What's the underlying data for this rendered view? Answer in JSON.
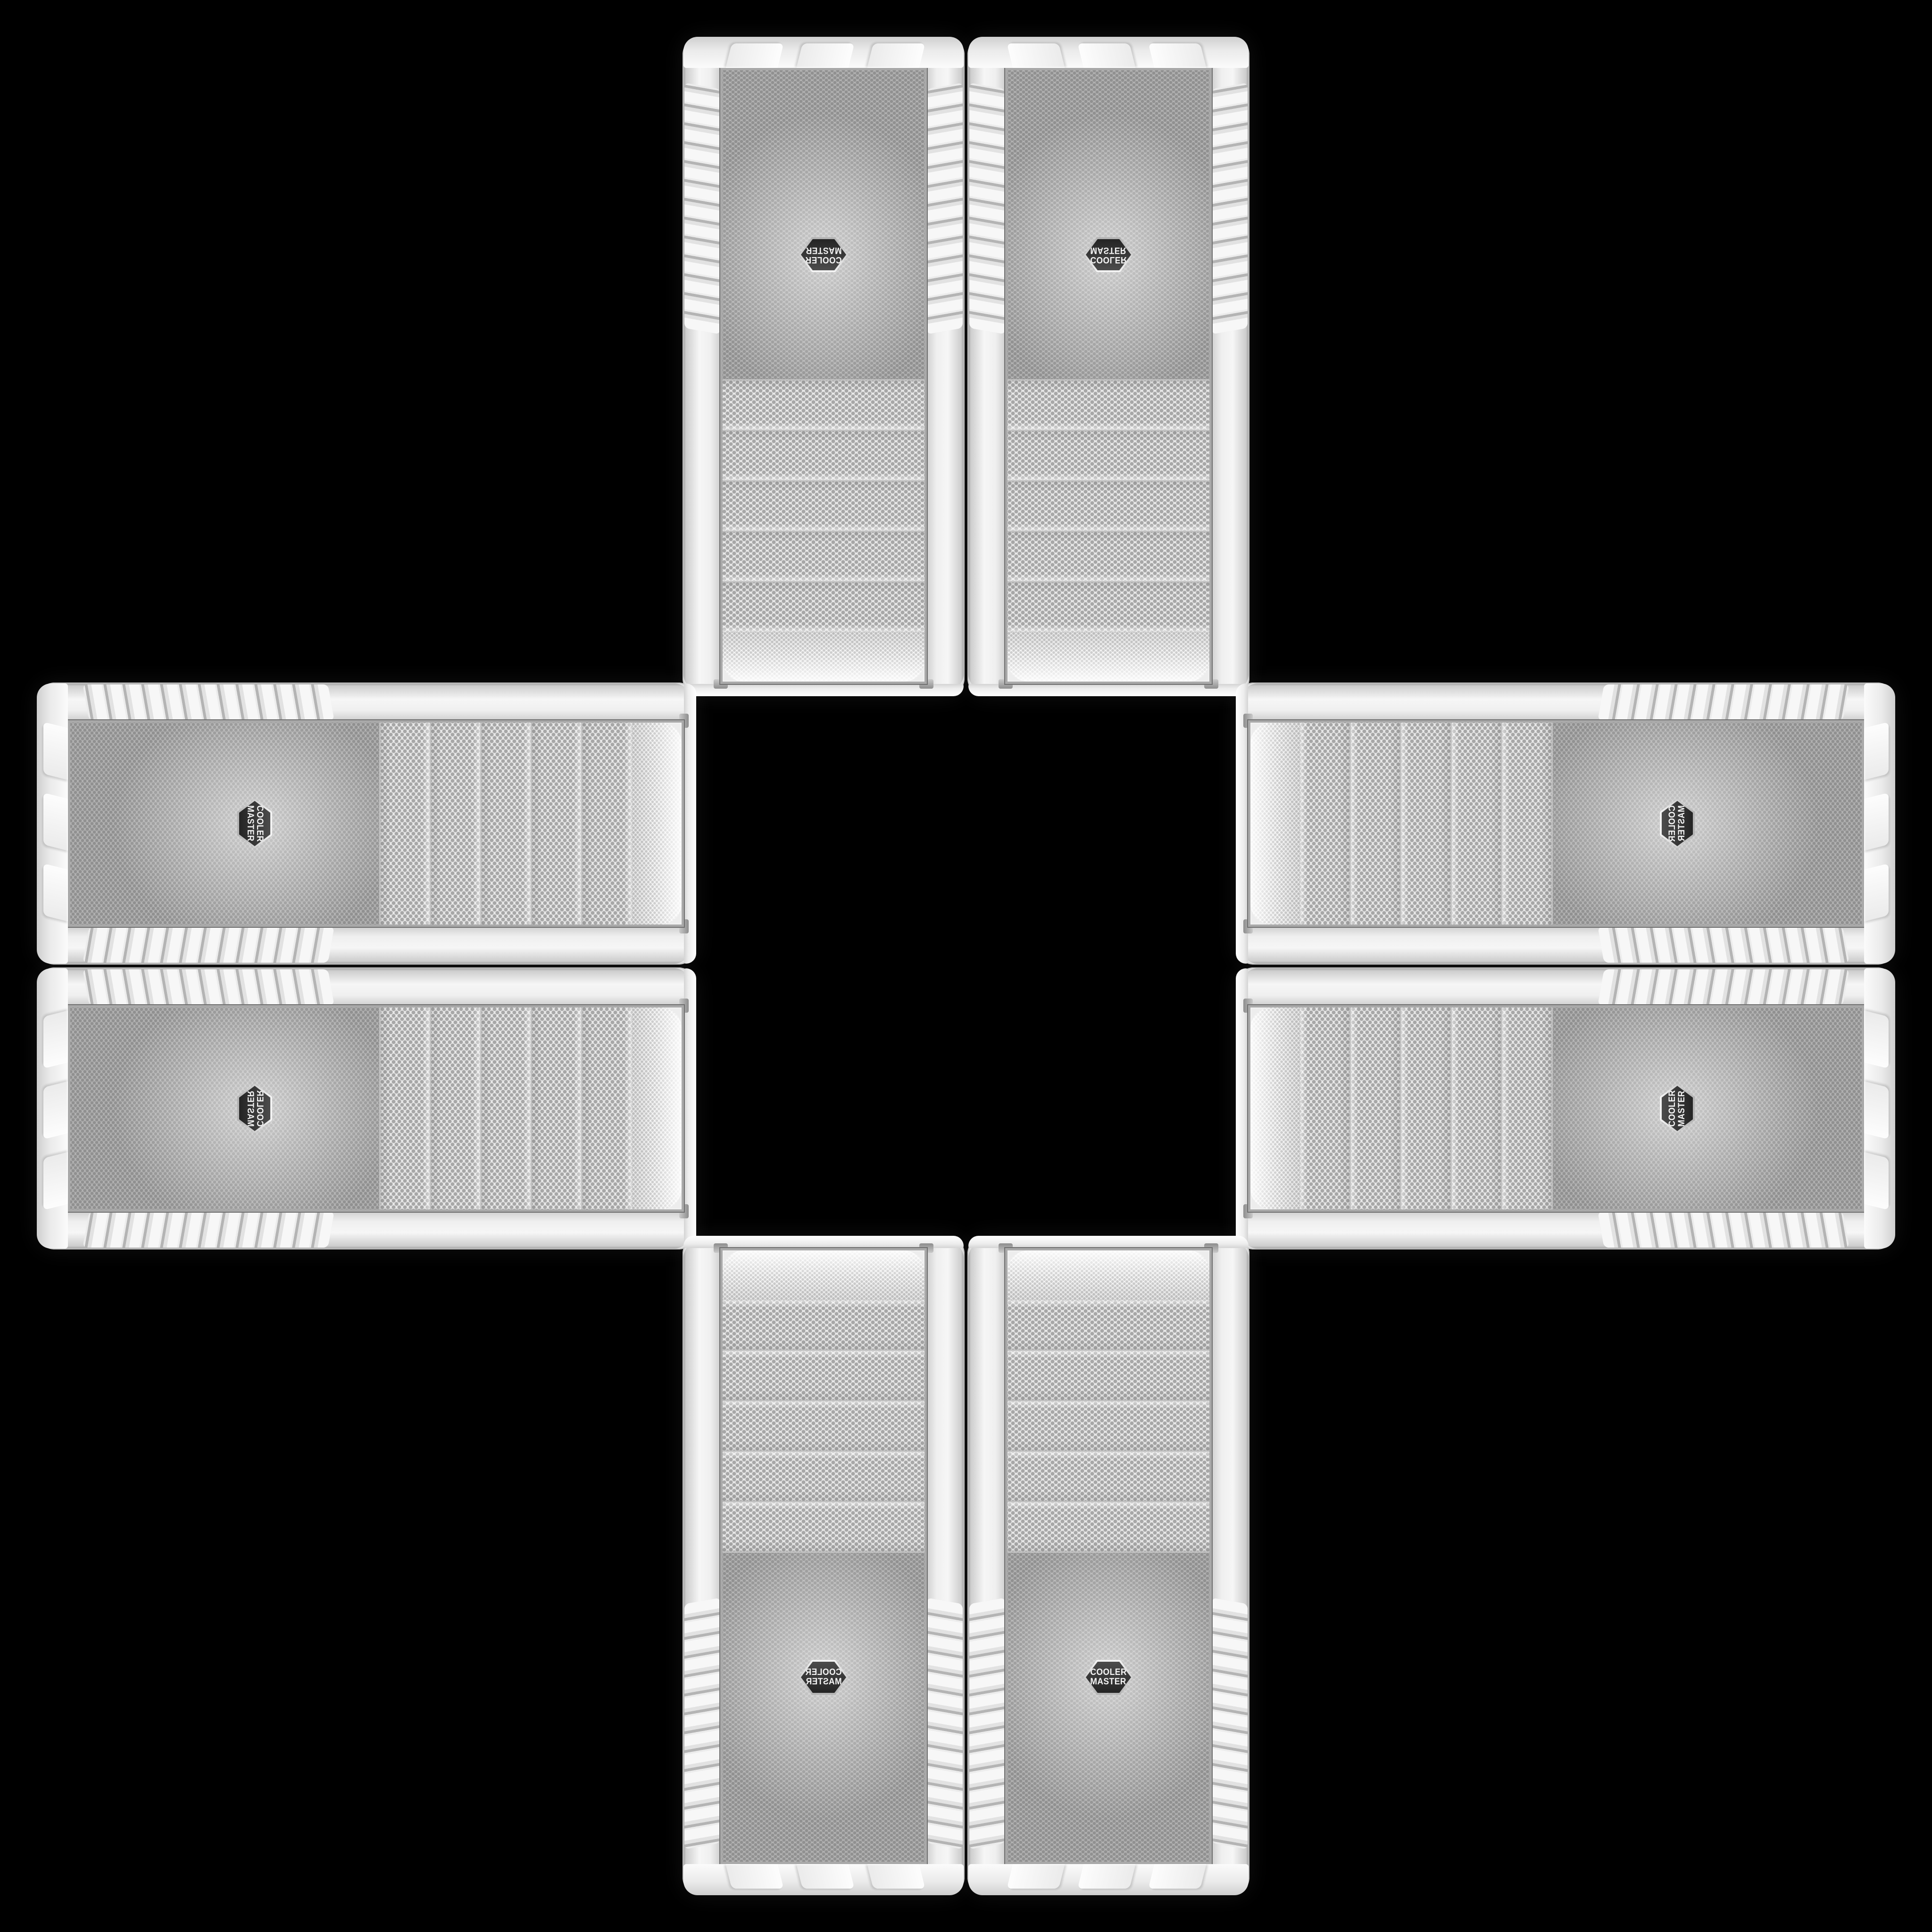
{
  "scene": {
    "description": "Eight identical white Cooler Master computer case front panels arranged edge-to-edge in a plus / cross kaleidoscope pattern on a black background",
    "background_color": "#000000",
    "panel_count": 8,
    "drive_bay_covers_per_panel": 5
  },
  "brand": {
    "line1": "COOLER",
    "line2": "MASTER"
  },
  "panels": [
    {
      "slot": "top-left",
      "orientation": "rotated 180"
    },
    {
      "slot": "top-right",
      "orientation": "rotated 180, mirrored"
    },
    {
      "slot": "left-top",
      "orientation": "rotated 90 clockwise"
    },
    {
      "slot": "right-top",
      "orientation": "rotated 90, mirrored"
    },
    {
      "slot": "left-bottom",
      "orientation": "rotated 90, flipped"
    },
    {
      "slot": "right-bottom",
      "orientation": "rotated 270"
    },
    {
      "slot": "bottom-left",
      "orientation": "mirrored"
    },
    {
      "slot": "bottom-right",
      "orientation": "upright"
    }
  ],
  "colors": {
    "shell": "#ececec",
    "shell_highlight": "#fafafa",
    "shell_shadow": "#c7c7c7",
    "mesh_background": "#ededed",
    "mesh_dot": "#aaaaaa",
    "chrome_trim": "#a9a9a9",
    "badge_background": "#2e2e2e",
    "badge_ring": "#d9d9d9",
    "badge_text": "#f5f5f5"
  }
}
